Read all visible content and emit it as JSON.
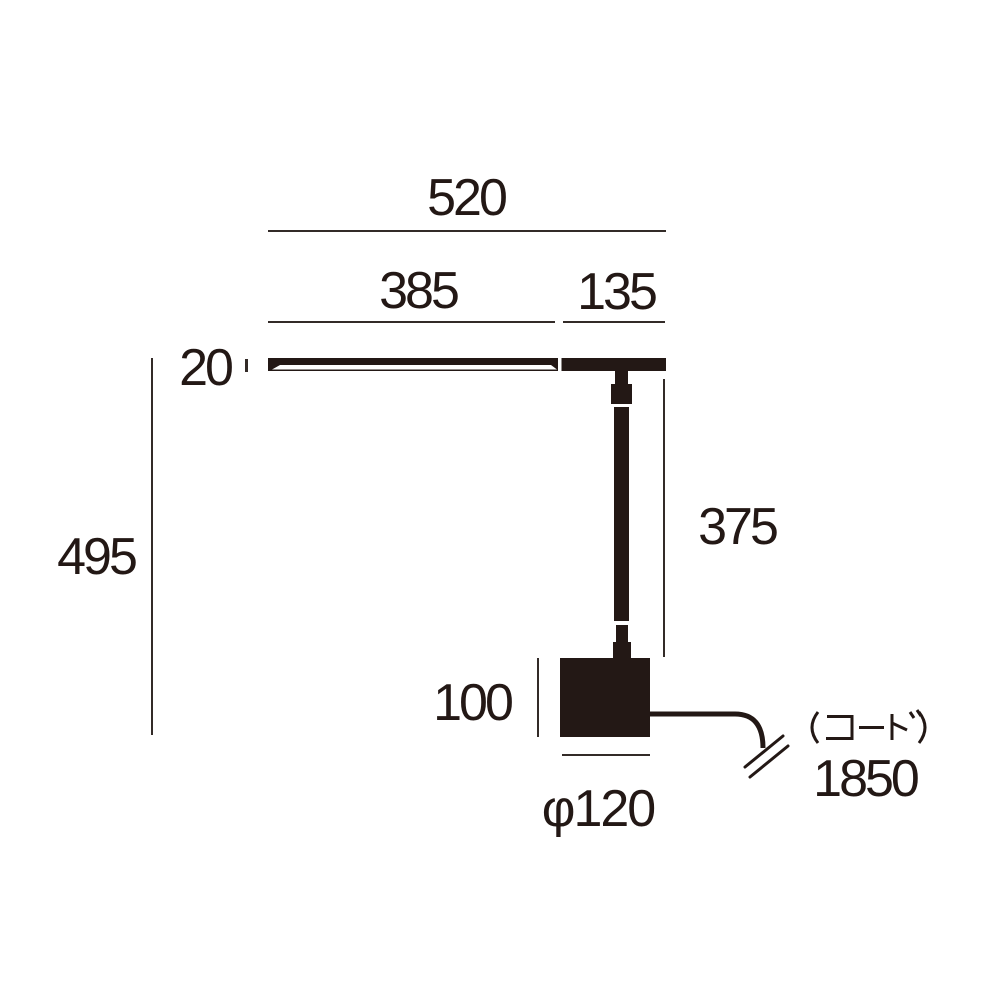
{
  "colors": {
    "ink": "#231815",
    "line": "#332B28",
    "background": "#FFFFFF"
  },
  "labels": {
    "overall_width": "520",
    "shade_length": "385",
    "rear_length": "135",
    "shade_thickness": "20",
    "overall_height": "495",
    "pole_height": "375",
    "base_height": "100",
    "base_diameter": "φ120",
    "cord": "(コード)",
    "cord_length": "1850"
  }
}
